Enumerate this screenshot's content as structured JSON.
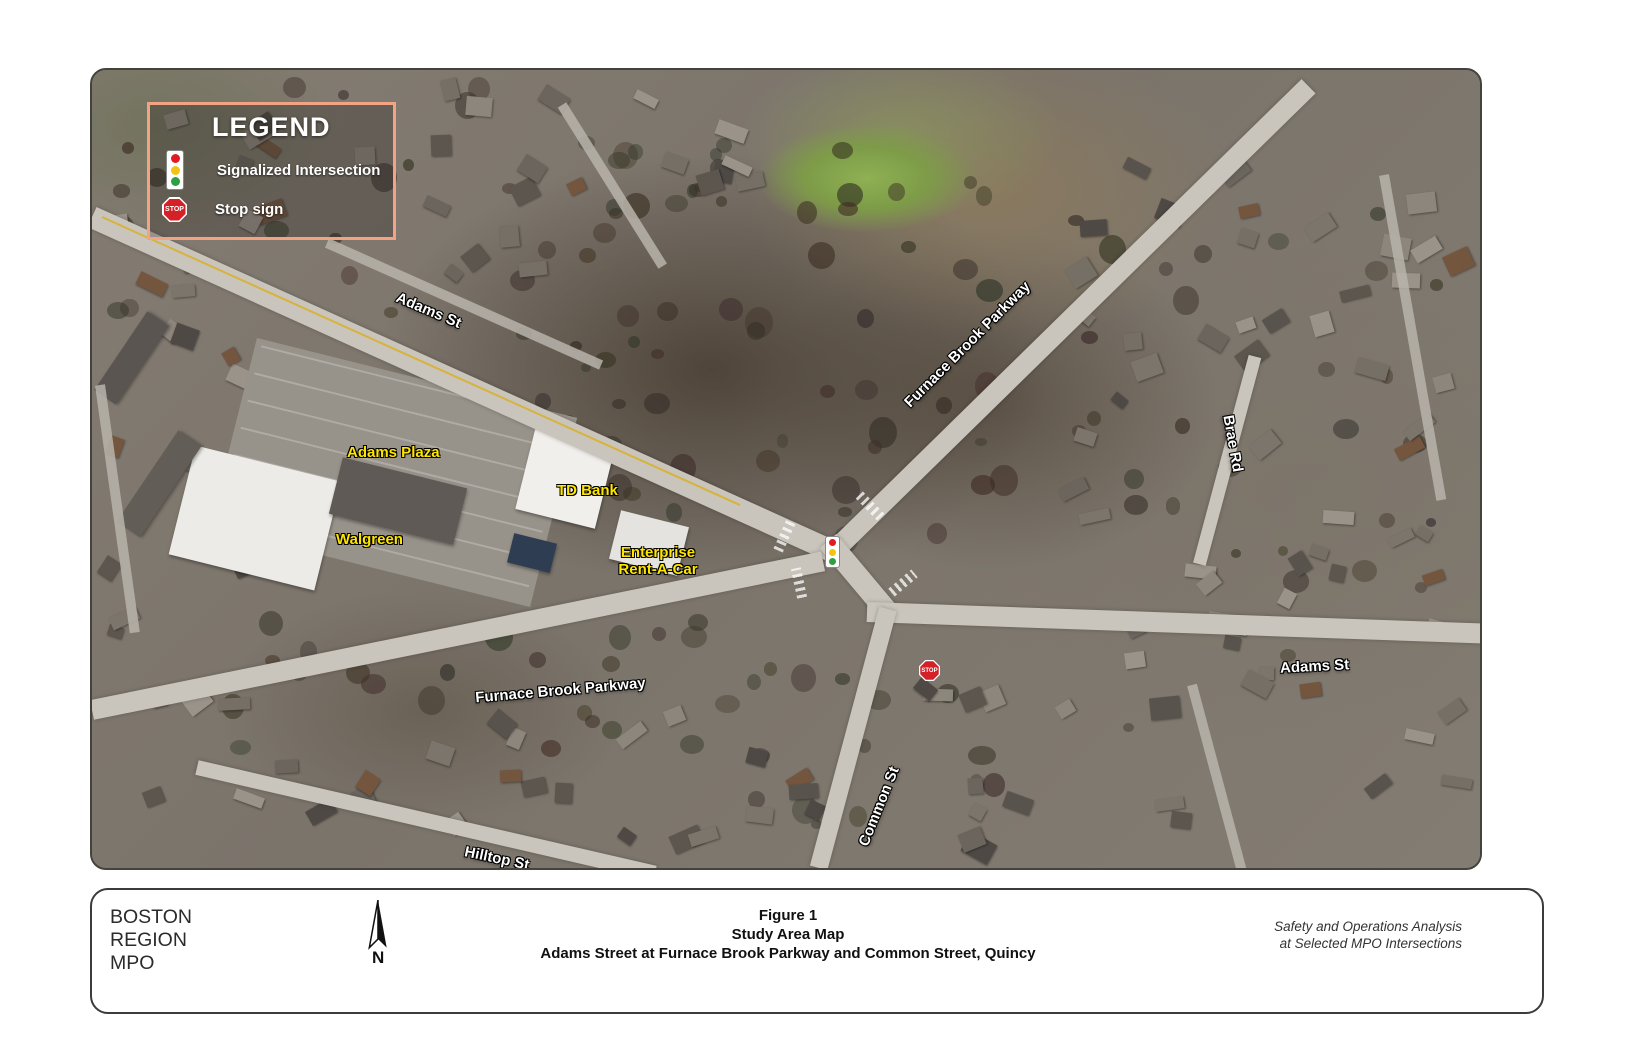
{
  "legend": {
    "title": "LEGEND",
    "items": [
      {
        "icon": "traffic-signal-icon",
        "label": "Signalized Intersection"
      },
      {
        "icon": "stop-sign-icon",
        "label": "Stop sign"
      }
    ],
    "stop_sign_text": "STOP",
    "border_color": "#f2a383"
  },
  "map": {
    "street_labels": [
      {
        "id": "adams-st-west",
        "text": "Adams St"
      },
      {
        "id": "furnace-brook-parkway-ne",
        "text": "Furnace Brook Parkway"
      },
      {
        "id": "brae-rd",
        "text": "Brae Rd"
      },
      {
        "id": "furnace-brook-parkway-sw",
        "text": "Furnace Brook Parkway"
      },
      {
        "id": "adams-st-east",
        "text": "Adams St"
      },
      {
        "id": "common-st",
        "text": "Common St"
      },
      {
        "id": "hilltop-st",
        "text": "Hilltop St"
      }
    ],
    "place_labels": [
      {
        "id": "adams-plaza",
        "lines": [
          "Adams Plaza"
        ]
      },
      {
        "id": "td-bank",
        "lines": [
          "TD Bank"
        ]
      },
      {
        "id": "walgreen",
        "lines": [
          "Walgreen"
        ]
      },
      {
        "id": "enterprise",
        "lines": [
          "Enterprise",
          "Rent-A-Car"
        ]
      }
    ],
    "markers": {
      "signalized_intersection": {
        "type": "traffic-signal"
      },
      "stop_sign": {
        "text": "STOP"
      }
    },
    "street_label_color": "#ffffff",
    "place_label_color": "#ffe600"
  },
  "footer": {
    "org_lines": [
      "BOSTON",
      "REGION",
      "MPO"
    ],
    "north_label": "N",
    "title_lines": [
      "Figure 1",
      "Study Area Map",
      "Adams Street at Furnace Brook Parkway and Common Street, Quincy"
    ],
    "note_lines": [
      "Safety and Operations Analysis",
      "at Selected MPO Intersections"
    ]
  }
}
